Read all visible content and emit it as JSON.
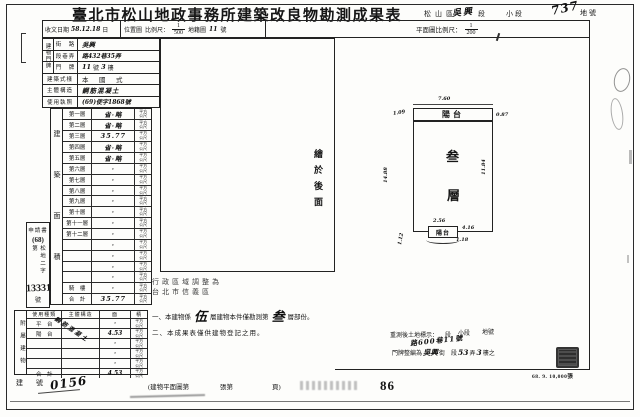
{
  "page": {
    "title": "臺北市松山地政事務所建築改良物勘測成果表",
    "district": "松山區",
    "section_hw": "吳興",
    "section_suffix": "段",
    "small_section": "小段",
    "lot_hw": "737",
    "lot_suffix": "地號",
    "print_code": "68. 9. 10,000張",
    "page_number": "86"
  },
  "header": {
    "receipt_label": "收文日期",
    "receipt_value": "58.12.18",
    "receipt_suffix": "日",
    "location_label": "位置圖",
    "scale_label": "比例尺：",
    "scale_num": "1",
    "scale_den": "500",
    "cadastral_label": "地籍圖",
    "cadastral_value": "11",
    "cadastral_suffix": "號",
    "plan_scale_label": "平面圖比例尺：",
    "plan_scale_num": "1",
    "plan_scale_den": "200"
  },
  "building": {
    "address_label": "建物門牌",
    "street_label": "街　路",
    "street_value": "吳興",
    "lane_label": "段巷弄",
    "lane_value": "路432巷35弄",
    "door_label": "門　牌",
    "door_no": "11",
    "door_no_suffix": "號",
    "door_floor": "3",
    "door_floor_suffix": "樓",
    "style_label": "建築式樣",
    "style_value": "本　國　式",
    "structure_label": "主體構造",
    "structure_value": "鋼筋混凝土",
    "license_label": "使用執照",
    "license_value": "(69)使字1868號"
  },
  "floor_area": {
    "label": "建築面積",
    "unit_top": "平方",
    "unit_bottom": "公尺",
    "rows": [
      {
        "name": "第一層",
        "value": "省·略"
      },
      {
        "name": "第二層",
        "value": "省·略"
      },
      {
        "name": "第三層",
        "value": "35.77"
      },
      {
        "name": "第四層",
        "value": "省·略"
      },
      {
        "name": "第五層",
        "value": "省·略"
      },
      {
        "name": "第六層",
        "value": "·"
      },
      {
        "name": "第七層",
        "value": "·"
      },
      {
        "name": "第八層",
        "value": "·"
      },
      {
        "name": "第九層",
        "value": "·"
      },
      {
        "name": "第十層",
        "value": "·"
      },
      {
        "name": "第十一層",
        "value": "·"
      },
      {
        "name": "第十二層",
        "value": "·"
      },
      {
        "name": "",
        "value": "·"
      },
      {
        "name": "",
        "value": "·"
      },
      {
        "name": "",
        "value": "·"
      },
      {
        "name": "",
        "value": "·"
      },
      {
        "name": "騎　樓",
        "value": "·"
      },
      {
        "name": "合　計",
        "value": "35.77"
      }
    ]
  },
  "application": {
    "line1": "申請書",
    "line2": "(68)",
    "line3": "松地二字第",
    "number": "13331",
    "suffix": "號"
  },
  "attachment": {
    "label": "附屬建物",
    "col_type": "使用種類",
    "col_structure": "主體構造",
    "col_area_1": "面",
    "col_area_2": "積",
    "structure_hw": "鋼筋混凝土",
    "unit_top": "平方",
    "unit_bottom": "公尺",
    "rows": [
      {
        "type": "平　台",
        "area": "·"
      },
      {
        "type": "陽　台",
        "area": "4.53"
      },
      {
        "type": "",
        "area": "·"
      },
      {
        "type": "",
        "area": "·"
      },
      {
        "type": "",
        "area": "·"
      },
      {
        "type": "合　計",
        "area": "4.53"
      }
    ]
  },
  "building_number": {
    "label": "建　號",
    "value": "0156"
  },
  "map_note": "繪於後面",
  "plan": {
    "balcony": "陽台",
    "floor_char_1": "叁",
    "floor_char_2": "層",
    "small_balcony": "陽台",
    "dim_top": "7.60",
    "dim_top_left": "1.09",
    "dim_top_right": "0.87",
    "dim_left": "14.88",
    "dim_right": "11.84",
    "dim_sb_top": "2.56",
    "dim_sb_right": "4.16",
    "dim_sb_bottom": "1.18",
    "dim_sb_left": "1.12"
  },
  "admin_note": {
    "line1": "行政區域調整為",
    "line2": "台北市信義區"
  },
  "notes": {
    "n1_pre": "一、本建物係",
    "n1_hw1": "伍",
    "n1_mid": "層建物本件僅勘測第",
    "n1_hw2": "叁",
    "n1_post": "層部份。",
    "n2": "二、本成果表僅供建物登記之用。"
  },
  "resurvey": {
    "label": "重測後土地標示：",
    "seg": "段",
    "small_seg": "小段",
    "lot": "地號",
    "hw_address": "路600巷11號",
    "door_label": "門牌整編為",
    "hw_street": "吳興",
    "street_suffix": "街",
    "seg2": "段",
    "hw_lane": "53",
    "lane_suffix": "弄",
    "hw_floor": "3",
    "floor_suffix": "樓之"
  },
  "footer": {
    "ref1": "(建物平面圖第",
    "ref2": "張第",
    "ref3": "頁)"
  }
}
